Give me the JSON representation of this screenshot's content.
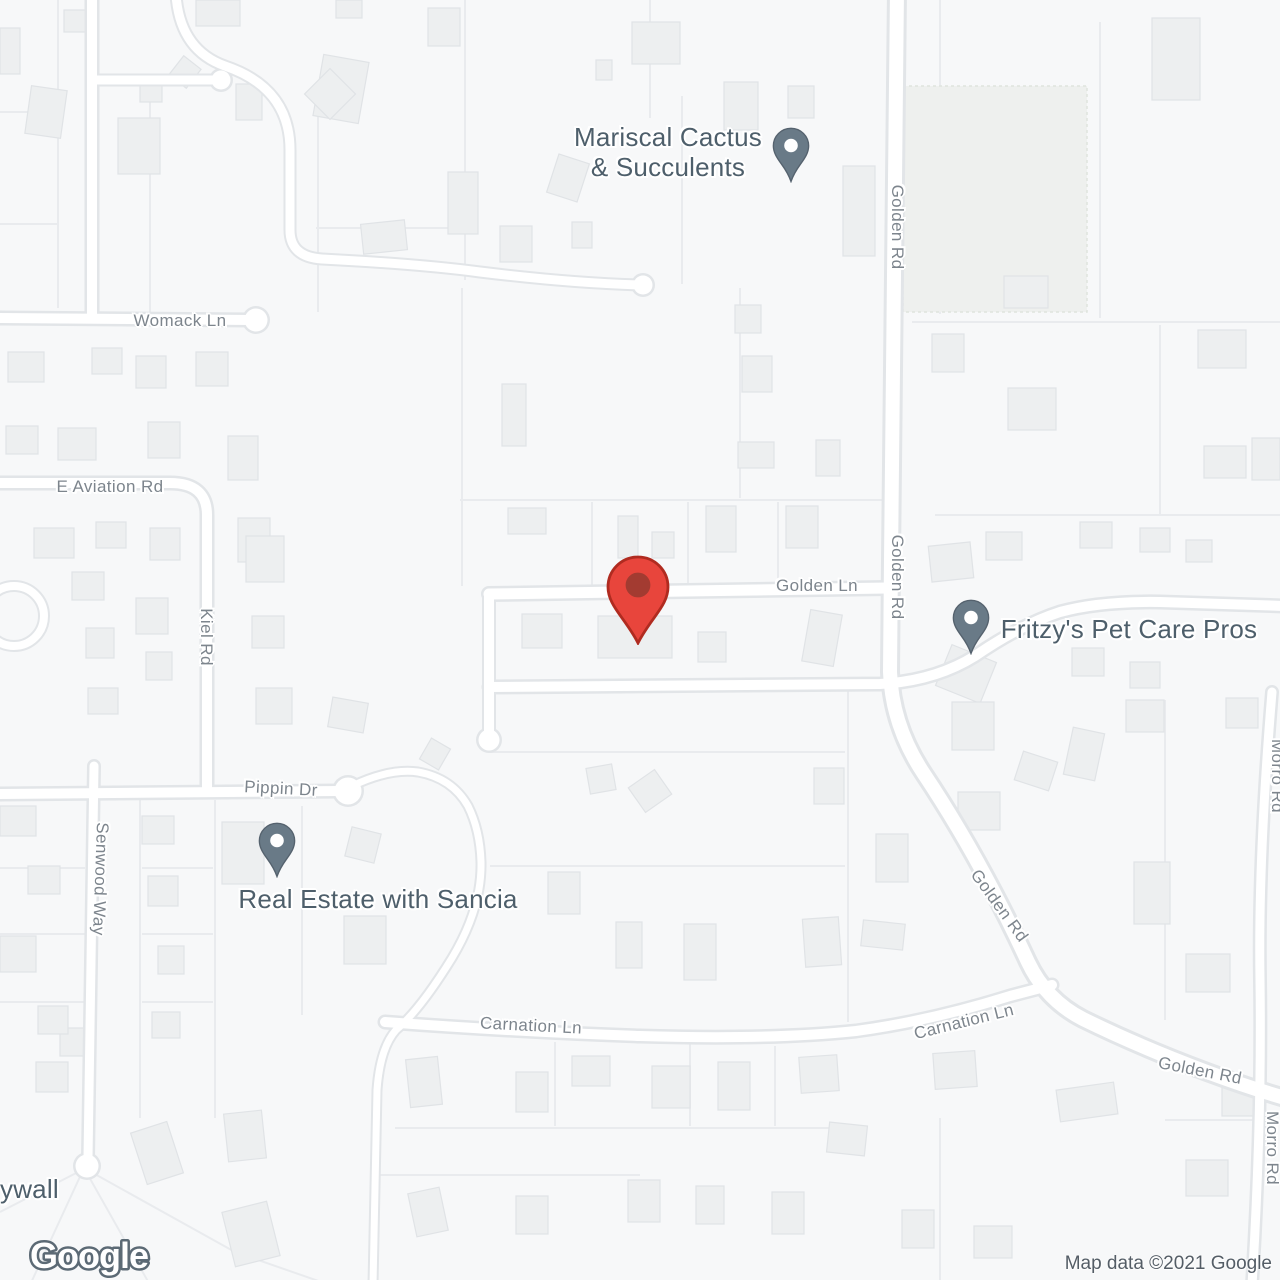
{
  "attribution": "Map data ©2021 Google",
  "logo_text": "Google",
  "pois": {
    "mariscal": {
      "line1": "Mariscal Cactus",
      "line2": "& Succulents"
    },
    "fritzys": {
      "label": "Fritzy's Pet Care Pros"
    },
    "sancia": {
      "label": "Real Estate with Sancia"
    },
    "edge_partial": {
      "label": "ywall"
    }
  },
  "roads": {
    "womack": "Womack Ln",
    "aviation": "E Aviation Rd",
    "golden_rd": "Golden Rd",
    "golden_ln": "Golden Ln",
    "kiel": "Kiel Rd",
    "pippin": "Pippin Dr",
    "senwood": "Senwood Way",
    "carnation": "Carnation Ln",
    "morro": "Morro Rd"
  },
  "colors": {
    "marker_red": "#E8453C",
    "marker_red_border": "#B02B20",
    "marker_red_dot": "#A33B31",
    "poi_pin": "#697A87",
    "poi_pin_border": "#55626E",
    "poi_label": "#4E5F6B",
    "road_label": "#7D858D"
  }
}
